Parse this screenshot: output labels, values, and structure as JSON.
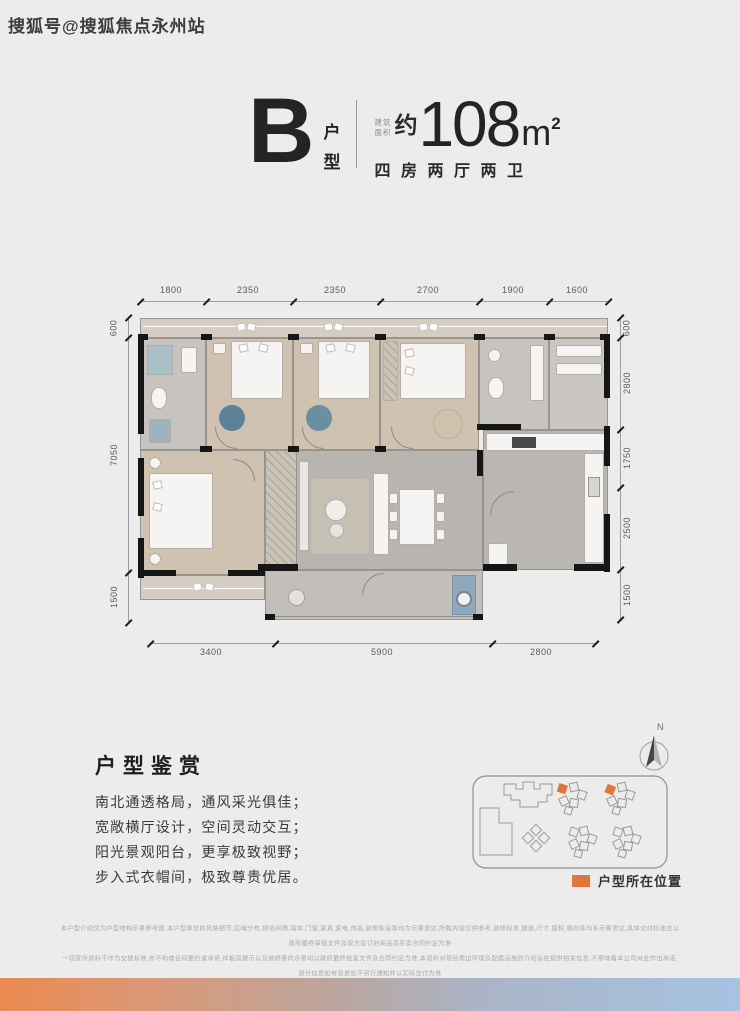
{
  "watermark": "搜狐号@搜狐焦点永州站",
  "header": {
    "unit_letter": "B",
    "unit_type_line1": "户",
    "unit_type_line2": "型",
    "area_label_line1": "建筑",
    "area_label_line2": "面积",
    "approx": "约",
    "area_value": "108",
    "area_unit": "m",
    "area_exponent": "2",
    "rooms_desc": "四房两厅两卫"
  },
  "floorplan": {
    "dims_top": [
      "1800",
      "2350",
      "2350",
      "2700",
      "1900",
      "1600"
    ],
    "dims_left": [
      "600",
      "7050",
      "1500"
    ],
    "dims_right": [
      "600",
      "2800",
      "1750",
      "2500",
      "1500"
    ],
    "dims_bottom": [
      "3400",
      "5900",
      "2800"
    ]
  },
  "appreciation": {
    "title": "户型鉴赏",
    "lines": [
      "南北通透格局，通风采光俱佳；",
      "宽敞横厅设计，空间灵动交互；",
      "阳光景观阳台，更享极致视野；",
      "步入式衣帽间，极致尊贵优居。"
    ]
  },
  "siteplan": {
    "compass_label": "N",
    "legend_label": "户型所在位置"
  },
  "disclaimer": {
    "lines": [
      "本户型介绍仅为户型结构示意参考图,本户型单位的风格细节,区域分布,相邻间隔,墙体,门窗,家具,家电,饰品,装修陈设等均为示意表达,所载内容仅供参考,装修标准,建造,尺寸,面积,朝向等均系示意表达,具体交付标准应以政府最终审批文件及双方签订的商品房买卖合同约定为准",
      "一切宣传资料不作为交楼标准,亦不构成任何要约或承诺,样板房展示以及装修意向示意均以政府最终批复文件及合同约定为准,本资料对项目周边环境及配套设施的介绍旨在提供相关信息,不意味着本公司对此作出承诺,部分信息如有变更恕不另行通知并以实际交付为准",
      "本资料为公司的宣传推广资料,属要约邀请或宣传内容,解释权归开发商所有并保留修改权利,本资料制作时间2022年10月。"
    ]
  },
  "colors": {
    "accent_orange": "#e0763c",
    "gradient_left": "#eb8a4f",
    "gradient_right": "#a6c3e2"
  }
}
